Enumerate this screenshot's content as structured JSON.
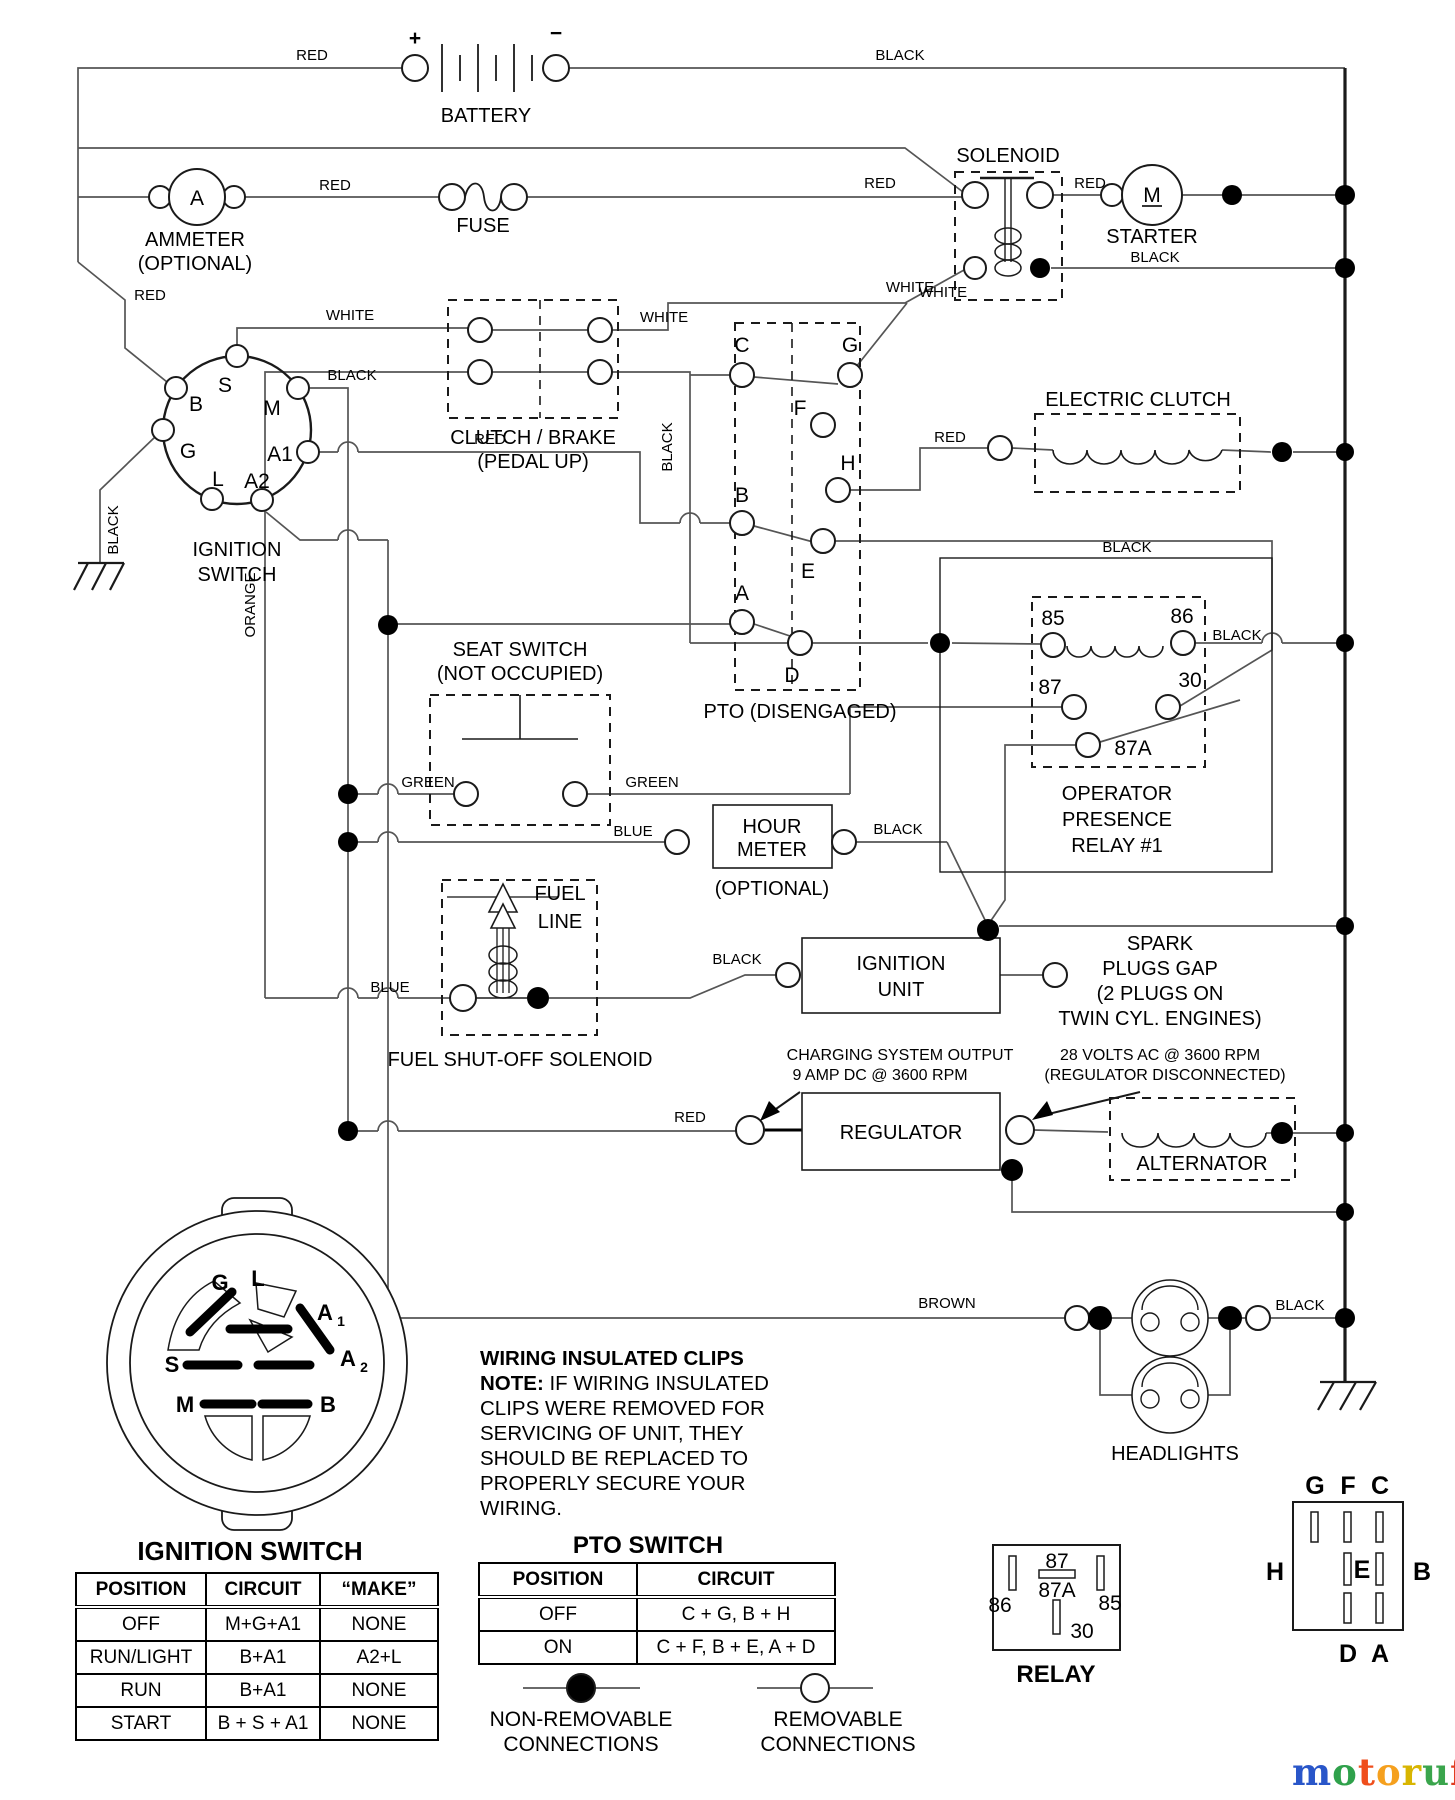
{
  "wire_colors": {
    "red": "RED",
    "black": "BLACK",
    "white": "WHITE",
    "green": "GREEN",
    "blue": "BLUE",
    "orange": "ORANGE",
    "brown": "BROWN"
  },
  "battery": {
    "name": "BATTERY",
    "plus": "+",
    "minus": "−"
  },
  "ammeter": {
    "symbol": "A",
    "line1": "AMMETER",
    "line2": "(OPTIONAL)"
  },
  "fuse": {
    "name": "FUSE"
  },
  "solenoid": {
    "name": "SOLENOID"
  },
  "starter": {
    "name": "STARTER",
    "symbol": "M"
  },
  "ignition_switch": {
    "line1": "IGNITION",
    "line2": "SWITCH",
    "terminals": {
      "s": "S",
      "b": "B",
      "m": "M",
      "g": "G",
      "a1": "A1",
      "l": "L",
      "a2": "A2"
    }
  },
  "clutch_brake": {
    "line1": "CLUTCH / BRAKE",
    "line2": "(PEDAL UP)"
  },
  "pto_switch": {
    "name": "PTO (DISENGAGED)",
    "terminals": {
      "c": "C",
      "g": "G",
      "f": "F",
      "h": "H",
      "b": "B",
      "e": "E",
      "a": "A",
      "d": "D"
    }
  },
  "electric_clutch": {
    "name": "ELECTRIC CLUTCH"
  },
  "seat_switch": {
    "line1": "SEAT SWITCH",
    "line2": "(NOT OCCUPIED)"
  },
  "operator_relay": {
    "line1": "OPERATOR",
    "line2": "PRESENCE",
    "line3": "RELAY #1",
    "terminals": {
      "t85": "85",
      "t86": "86",
      "t87": "87",
      "t30": "30",
      "t87a": "87A"
    }
  },
  "hour_meter": {
    "line1": "HOUR",
    "line2": "METER",
    "line3": "(OPTIONAL)"
  },
  "fuel_solenoid": {
    "line1": "FUEL",
    "line2": "LINE",
    "caption": "FUEL SHUT-OFF SOLENOID"
  },
  "ignition_unit": {
    "line1": "IGNITION",
    "line2": "UNIT"
  },
  "spark_plugs": {
    "line1": "SPARK",
    "line2": "PLUGS GAP",
    "line3": "(2 PLUGS ON",
    "line4": "TWIN CYL. ENGINES)"
  },
  "regulator": {
    "name": "REGULATOR",
    "charging_note_line1": "CHARGING SYSTEM OUTPUT",
    "charging_note_line2": "9 AMP DC @ 3600 RPM",
    "ac_note_line1": "28 VOLTS AC @ 3600 RPM",
    "ac_note_line2": "(REGULATOR DISCONNECTED)"
  },
  "alternator": {
    "name": "ALTERNATOR"
  },
  "headlights": {
    "name": "HEADLIGHTS"
  },
  "connector_view": {
    "heading": "IGNITION SWITCH",
    "pins": {
      "g": "G",
      "l": "L",
      "a1_base": "A",
      "a1_sub": "1",
      "a2_base": "A",
      "a2_sub": "2",
      "s": "S",
      "m": "M",
      "b": "B"
    }
  },
  "ignition_table": {
    "headers": [
      "POSITION",
      "CIRCUIT",
      "“MAKE”"
    ],
    "rows": [
      [
        "OFF",
        "M+G+A1",
        "NONE"
      ],
      [
        "RUN/LIGHT",
        "B+A1",
        "A2+L"
      ],
      [
        "RUN",
        "B+A1",
        "NONE"
      ],
      [
        "START",
        "B + S + A1",
        "NONE"
      ]
    ]
  },
  "pto_table": {
    "title": "PTO SWITCH",
    "headers": [
      "POSITION",
      "CIRCUIT"
    ],
    "rows": [
      [
        "OFF",
        "C + G, B + H"
      ],
      [
        "ON",
        "C + F, B + E, A + D"
      ]
    ]
  },
  "wiring_note": {
    "heading": "WIRING INSULATED CLIPS",
    "bold_prefix": "NOTE:",
    "line1": " IF WIRING INSULATED",
    "line2": "CLIPS WERE REMOVED FOR",
    "line3": "SERVICING OF UNIT, THEY",
    "line4": "SHOULD BE REPLACED TO",
    "line5": "PROPERLY SECURE YOUR WIRING."
  },
  "legend": {
    "non_removable_line1": "NON-REMOVABLE",
    "non_removable_line2": "CONNECTIONS",
    "removable_line1": "REMOVABLE",
    "removable_line2": "CONNECTIONS"
  },
  "relay_module": {
    "name": "RELAY",
    "pins": {
      "p87": "87",
      "p87a": "87A",
      "p86": "86",
      "p85": "85",
      "p30": "30"
    }
  },
  "socket_view": {
    "top": [
      "G",
      "F",
      "C"
    ],
    "left": "H",
    "center": "E",
    "right": "B",
    "bottom": [
      "D",
      "A"
    ]
  },
  "logo": {
    "letters": [
      "m",
      "o",
      "t",
      "o",
      "r",
      "u",
      "f"
    ],
    "suffix": ".de",
    "letter_colors": [
      "#2956c9",
      "#2fa14b",
      "#ef4e1c",
      "#f5a01e",
      "#d8b501",
      "#3aa54c",
      "#e03c20"
    ]
  }
}
